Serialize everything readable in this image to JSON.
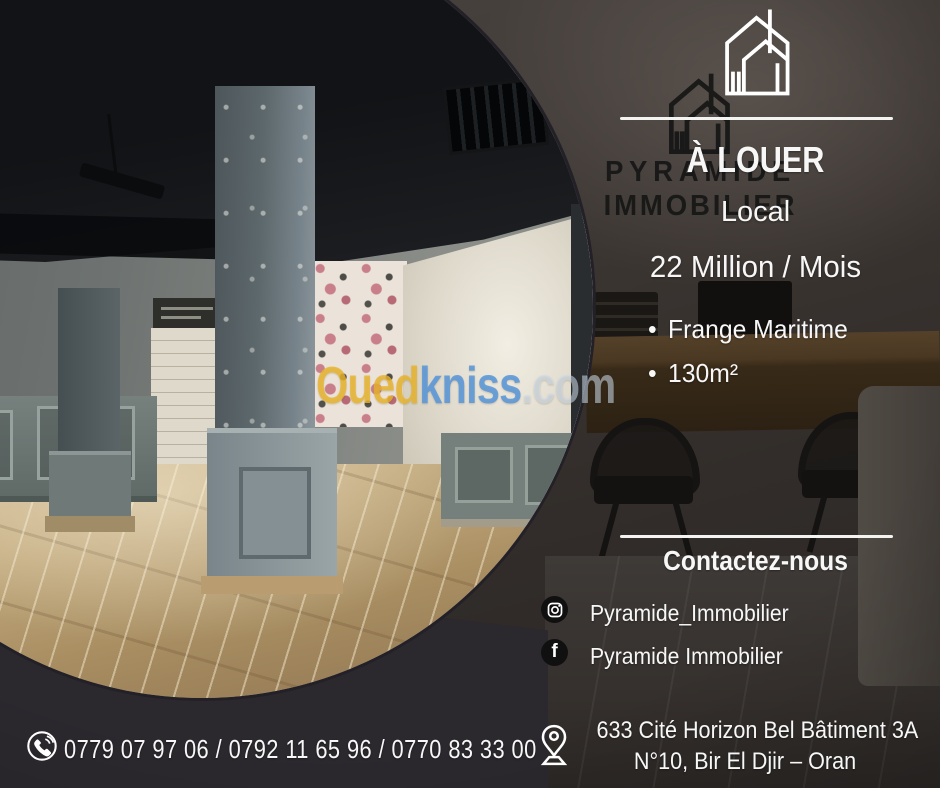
{
  "brand": {
    "background_sign": {
      "line1": "PYRAMIDE",
      "line2": "IMMOBILIER"
    }
  },
  "listing": {
    "status_label": "À LOUER",
    "property_type": "Local",
    "price": "22 Million / Mois",
    "bullet": "•",
    "features": [
      "Frange Maritime",
      "130m²"
    ]
  },
  "contact": {
    "heading": "Contactez-nous",
    "instagram_handle": "Pyramide_Immobilier",
    "facebook_name": "Pyramide Immobilier",
    "facebook_glyph": "f",
    "address_line1": "633 Cité Horizon Bel Bâtiment 3A",
    "address_line2": "N°10, Bir El Djir – Oran",
    "phone_numbers": "0779 07 97 06 / 0792 11 65 96 / 0770 83 33 00"
  },
  "watermark": {
    "part_site": "Oued",
    "part_site2": "kniss",
    "part_domain": ".com"
  },
  "colors": {
    "text": "#f7f7f7",
    "watermark_yellow": "#e9b42c",
    "watermark_blue": "#5797d9",
    "watermark_light": "#cddff0",
    "background_dark": "#38322f",
    "sign_dark": "#161616",
    "icon_disc": "#101010"
  }
}
